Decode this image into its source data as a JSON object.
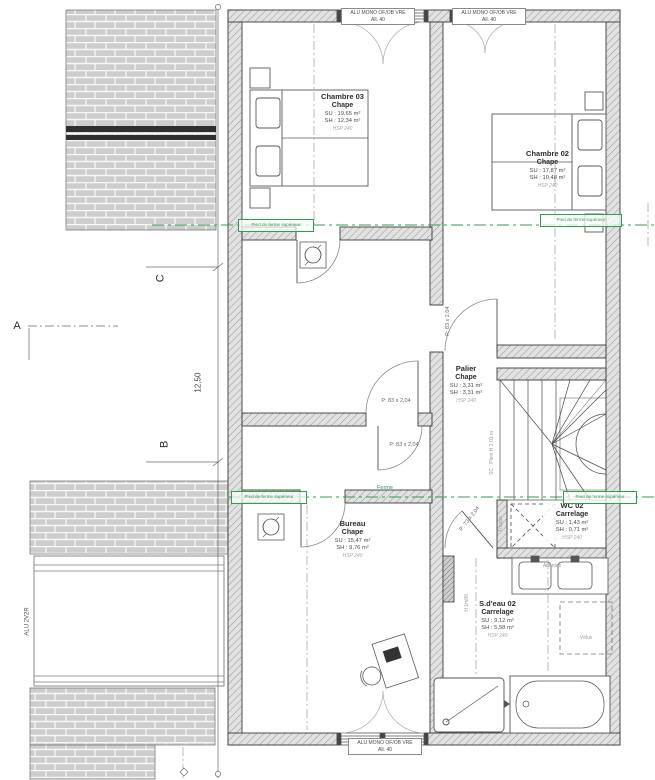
{
  "windows": {
    "label_line1": "ALU MONO OF/OB VRE",
    "label_line2": "All. 40",
    "left_window": "ALU 2V2R"
  },
  "rooms": [
    {
      "name": "Chambre 03",
      "finish": "Chape",
      "su": "SU : 19,65 m²",
      "sh": "SH : 12,34 m²",
      "hsp": "HSP 240"
    },
    {
      "name": "Chambre 02",
      "finish": "Chape",
      "su": "SU : 17,87 m²",
      "sh": "SH : 10,48 m²",
      "hsp": "HSP 240"
    },
    {
      "name": "Palier",
      "finish": "Chape",
      "su": "SU : 3,31 m²",
      "sh": "SH : 3,31 m²",
      "hsp": "HSP 240"
    },
    {
      "name": "Bureau",
      "finish": "Chape",
      "su": "SU : 15,47 m²",
      "sh": "SH : 9,76 m²",
      "hsp": "HSP 240"
    },
    {
      "name": "WC 02",
      "finish": "Carrelage",
      "su": "SU : 1,43 m²",
      "sh": "SH : 0,71 m²",
      "hsp": "HSP 240"
    },
    {
      "name": "S.d'eau 02",
      "finish": "Carrelage",
      "su": "SU : 9,12 m²",
      "sh": "SH : 5,58 m²",
      "hsp": "HSP 240"
    }
  ],
  "doors": {
    "p83": "P: 83 x 2,04",
    "p73": "P: 73 x 2,04"
  },
  "annotations": {
    "pied_ferme": "Pied de ferme supérieur",
    "ferme": "Ferme",
    "attentes": "Attentes",
    "velux": "Vélux",
    "trappe": "Trappe",
    "sc_plein": "SC : Plein H 1,01 m",
    "h180": "H 1m80"
  },
  "axes": {
    "a": "A",
    "b": "B",
    "c": "C",
    "dim_height": "12,50"
  },
  "colors": {
    "green": "#2ca04a",
    "wall_line": "#3a3a3a"
  }
}
